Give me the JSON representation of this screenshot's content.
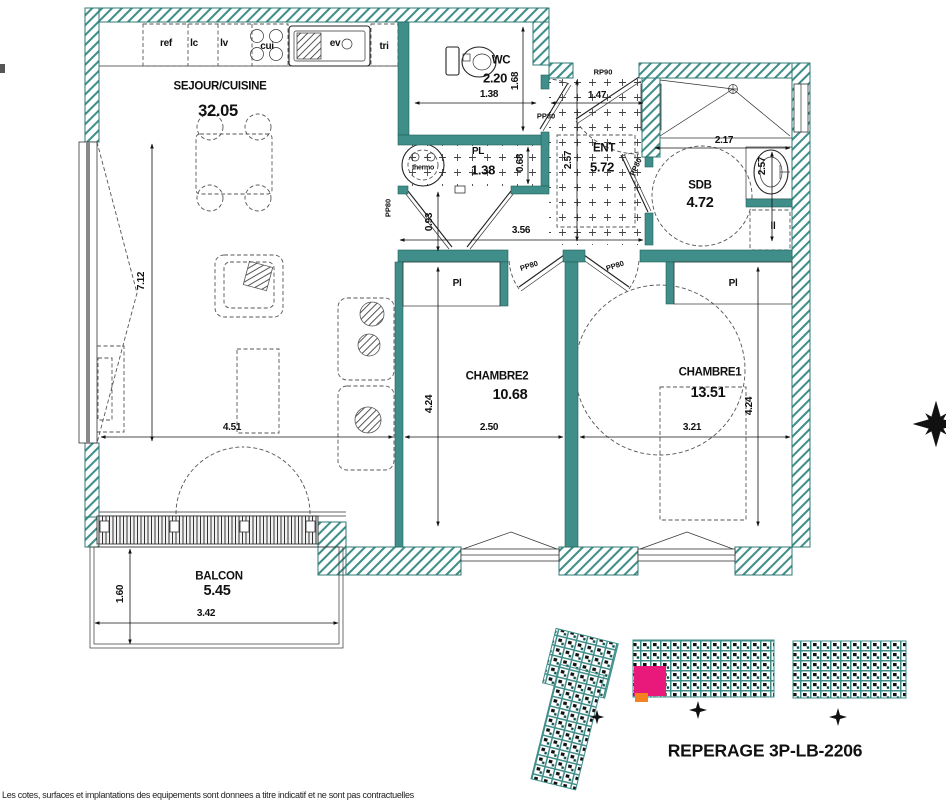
{
  "colors": {
    "wall_teal": "#3F8E89",
    "unit_highlight": "#E8197A",
    "unit_secondary": "#F58220"
  },
  "rooms": {
    "sejour": {
      "name": "SEJOUR/CUISINE",
      "area": "32.05"
    },
    "wc": {
      "name": "WC",
      "area": "2.20"
    },
    "pl": {
      "name": "PL",
      "area": "1.38"
    },
    "ent": {
      "name": "ENT",
      "area": "5.72"
    },
    "sdb": {
      "name": "SDB",
      "area": "4.72"
    },
    "chambre2": {
      "name": "CHAMBRE2",
      "area": "10.68"
    },
    "chambre1": {
      "name": "CHAMBRE1",
      "area": "13.51"
    },
    "balcon": {
      "name": "BALCON",
      "area": "5.45"
    }
  },
  "closets": {
    "ch2": "Pl",
    "ch1": "Pl"
  },
  "fixtures": {
    "thermo": "thermo",
    "washer": "ll"
  },
  "kitchen": {
    "ref": "ref",
    "lc": "lc",
    "lv": "lv",
    "cui": "cui",
    "ev": "ev",
    "tri": "tri"
  },
  "doors": {
    "entry": "RP90",
    "interior": "PP80"
  },
  "dims": {
    "sejour_h": "7.12",
    "sejour_w": "4.51",
    "wc_w": "1.38",
    "wc_h": "1.68",
    "ent_w": "1.47",
    "pl_h": "0.68",
    "ent_h": "2.57",
    "hall_h": "0.93",
    "hall_w": "3.56",
    "sdb_w": "2.17",
    "sdb_h": "2.57",
    "ch2_h": "4.24",
    "ch2_w": "2.50",
    "ch1_h": "4.24",
    "ch1_w": "3.21",
    "balcon_h": "1.60",
    "balcon_w": "3.42"
  },
  "keyplan": {
    "title": "REPERAGE 3P-LB-2206"
  },
  "footer": {
    "note": "Les cotes, surfaces et implantations des equipements sont donnees a titre indicatif et ne sont pas contractuelles"
  }
}
